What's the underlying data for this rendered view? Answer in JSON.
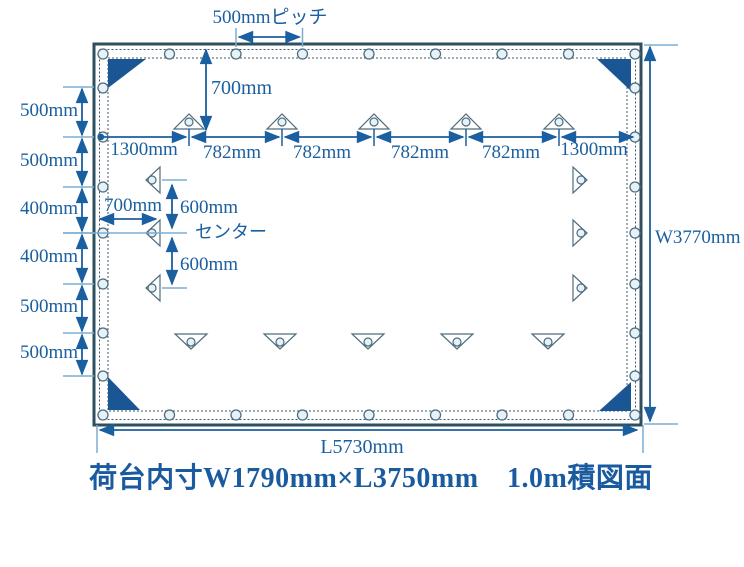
{
  "caption": "荷台内寸W1790mm×L3750mm　1.0m積図面",
  "dimensions": {
    "pitch_label": "500mmピッチ",
    "top_offset": "700mm",
    "top_row": [
      "1300mm",
      "782mm",
      "782mm",
      "782mm",
      "782mm",
      "1300mm"
    ],
    "left_column": [
      "500mm",
      "500mm",
      "400mm",
      "400mm",
      "500mm",
      "500mm"
    ],
    "center_offset_horizontal": "700mm",
    "center_upper": "600mm",
    "center_lower": "600mm",
    "center_label": "センター",
    "width_total": "W3770mm",
    "length_total": "L5730mm"
  },
  "colors": {
    "dimension_blue": "#1a5fa0",
    "border_dark": "#2e4f60",
    "corner_triangle_fill": "#1a5694",
    "light_tick_blue": "#7dadd2",
    "grommet_fill": "#e6f1f8",
    "outline_slate": "#4f6d7d",
    "background": "#ffffff"
  }
}
